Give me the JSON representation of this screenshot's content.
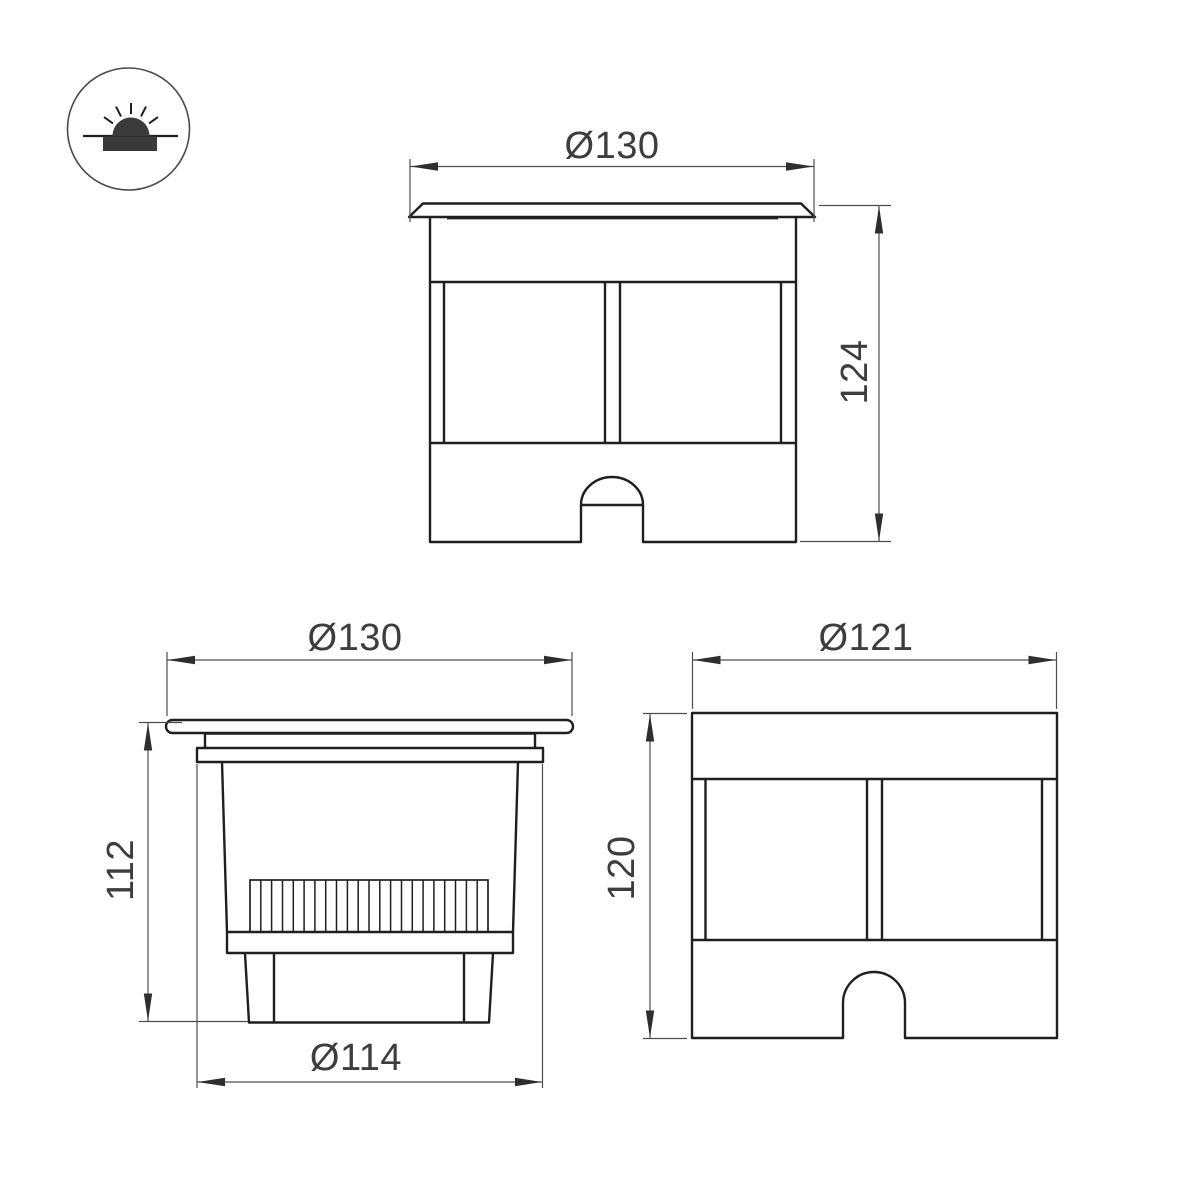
{
  "colors": {
    "background": "#ffffff",
    "object_line": "#1f1f1f",
    "dim_line": "#4d4d4d",
    "arrow": "#2e2e2e",
    "label_text": "#3d3d3d",
    "icon_dark": "#3a3a3a"
  },
  "icon": {
    "name": "recessed-inground-luminaire-symbol"
  },
  "views": {
    "front": {
      "dim_width": "Ø130",
      "dim_height": "124"
    },
    "side_section": {
      "dim_width": "Ø130",
      "dim_height": "112",
      "dim_bottom_width": "Ø114"
    },
    "sleeve": {
      "dim_width": "Ø121",
      "dim_height": "120"
    }
  }
}
